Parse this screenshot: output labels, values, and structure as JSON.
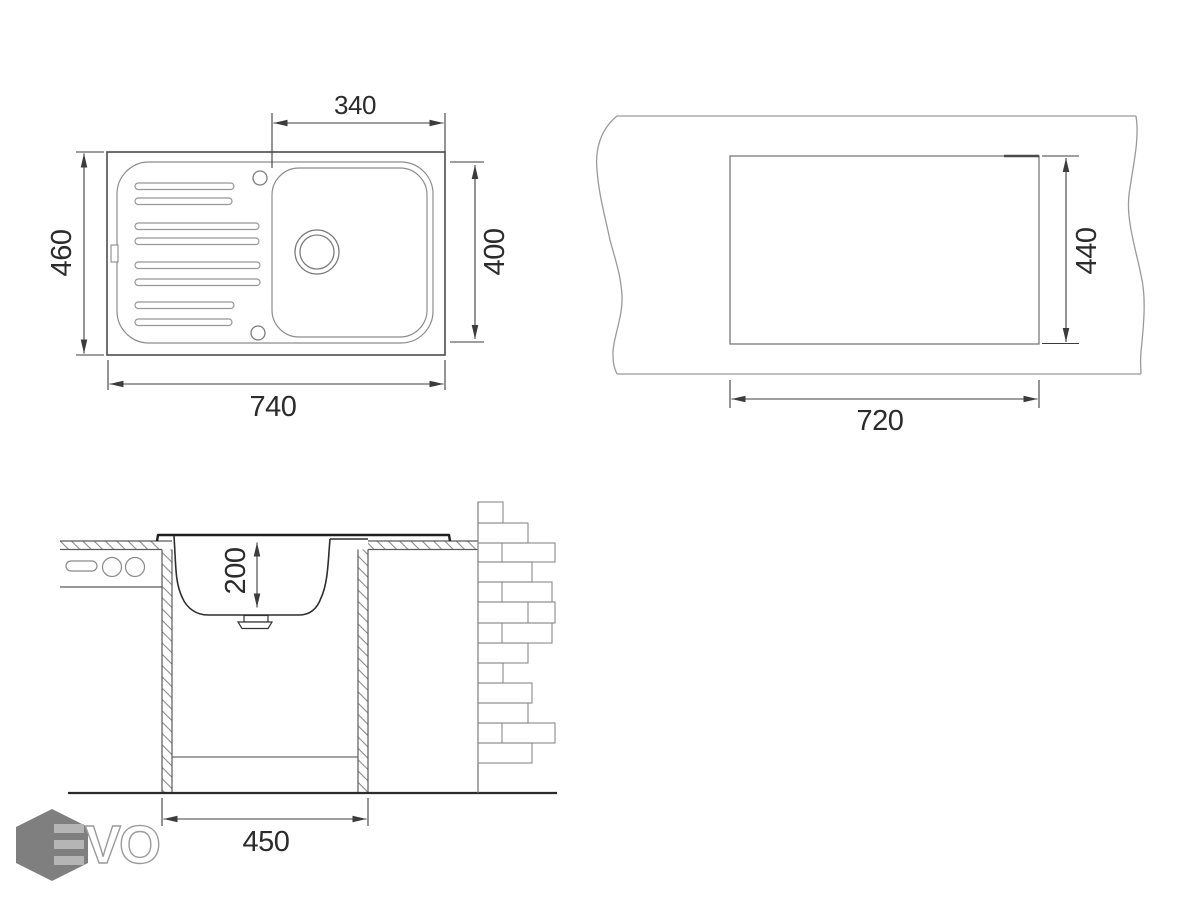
{
  "top_view": {
    "bowl_width": "340",
    "overall_depth": "460",
    "bowl_depth": "400",
    "overall_width": "740"
  },
  "cutout_view": {
    "cutout_width": "720",
    "cutout_depth": "440"
  },
  "section_view": {
    "bowl_height": "200",
    "cabinet_width": "450"
  },
  "logo": {
    "letters": "VO",
    "brand": "EVO",
    "icon": "evo-hexagon-icon"
  },
  "colors": {
    "background": "#ffffff",
    "line_primary": "#2e2e2e",
    "line_secondary": "#8c8c8c",
    "dimension_line": "#3c3c3c",
    "label_text": "#2b2b2b",
    "countertop_line": "#9a9a9a",
    "cutout_line": "#787878",
    "logo_hexagon": "#7f7f7f",
    "logo_bars": "#b5b5b5",
    "logo_letter_outline": "#9b9b9b"
  }
}
